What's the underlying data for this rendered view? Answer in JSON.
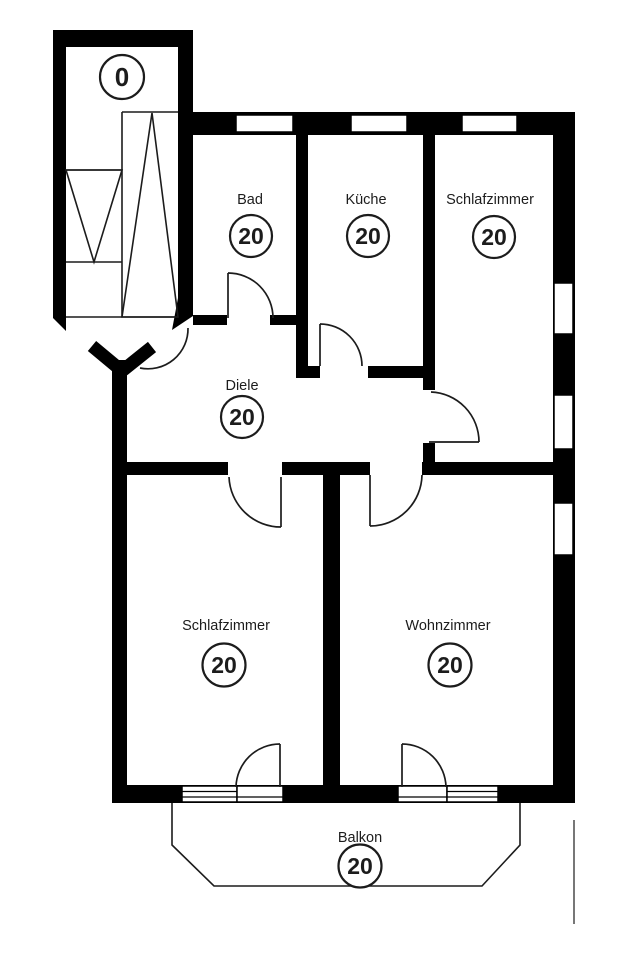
{
  "colors": {
    "wall": "#000000",
    "background": "#ffffff",
    "line": "#1c1c1c"
  },
  "rooms": [
    {
      "id": "treppenhaus",
      "label": "",
      "number": "0"
    },
    {
      "id": "bad",
      "label": "Bad",
      "number": "20"
    },
    {
      "id": "kueche",
      "label": "Küche",
      "number": "20"
    },
    {
      "id": "schlafzimmer-1",
      "label": "Schlafzimmer",
      "number": "20"
    },
    {
      "id": "diele",
      "label": "Diele",
      "number": "20"
    },
    {
      "id": "schlafzimmer-2",
      "label": "Schlafzimmer",
      "number": "20"
    },
    {
      "id": "wohnzimmer",
      "label": "Wohnzimmer",
      "number": "20"
    },
    {
      "id": "balkon",
      "label": "Balkon",
      "number": "20"
    }
  ]
}
